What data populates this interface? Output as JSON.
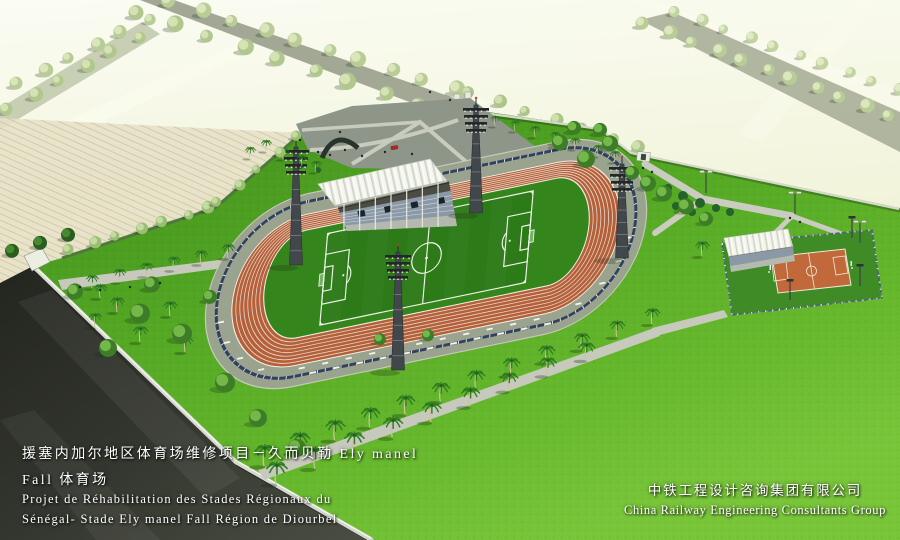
{
  "captions": {
    "project": {
      "zh_line1": "援塞内加尔地区体育场维修项目－久而贝勒 Ely manel",
      "zh_line2": "Fall 体育场",
      "fr_line1": "Projet de Réhabilitation des Stades Régionaux du",
      "fr_line2": "Sénégal- Stade Ely manel Fall Région de Diourbel"
    },
    "company": {
      "zh": "中铁工程设计咨询集团有限公司",
      "en": "China Railway Engineering Consultants Group"
    }
  },
  "colors": {
    "track_terracotta": "#b4613a",
    "pitch_green": "#2c7a18",
    "lawn_green": "#54a824",
    "court_orange": "#c2693c",
    "fence_navy": "#32415f",
    "roof_white": "#f4f5ee",
    "dark_road": "#2e302a",
    "pale_fields": "#eef1d6",
    "caption_text": "#ffffff"
  }
}
